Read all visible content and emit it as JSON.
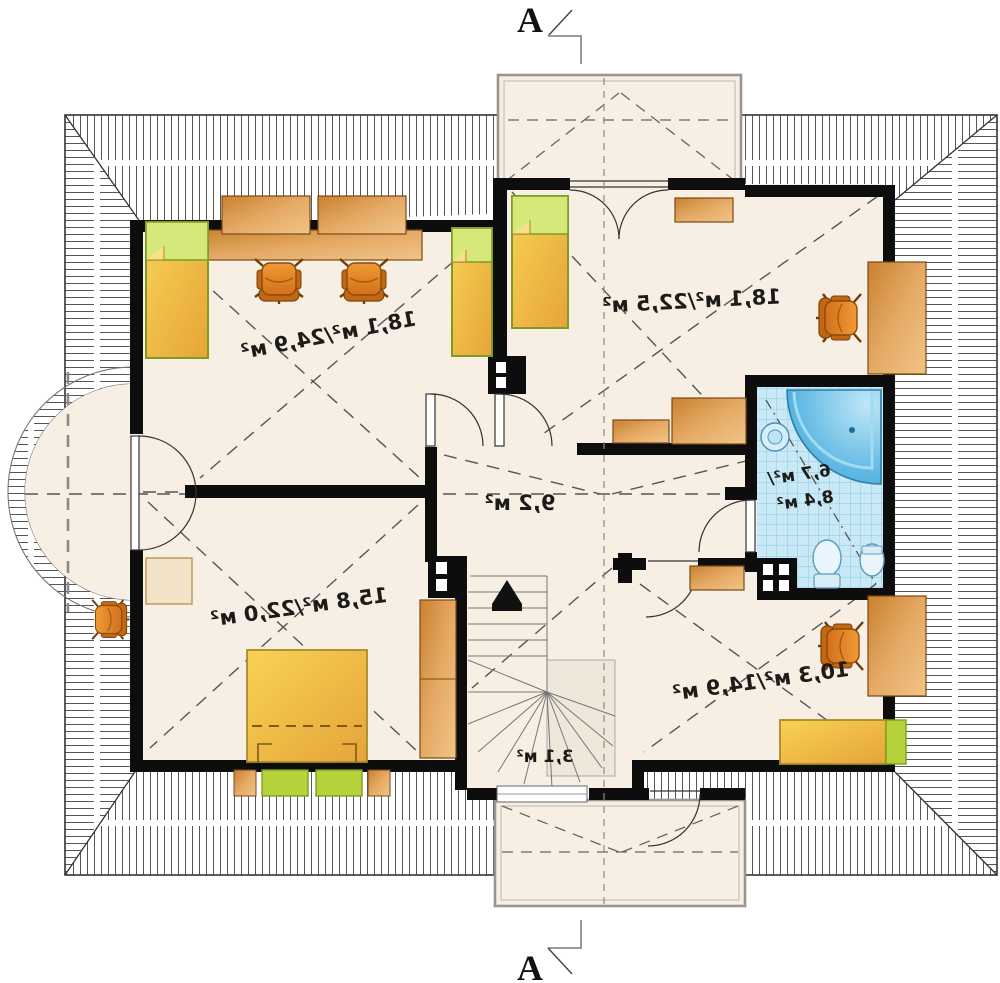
{
  "plan": {
    "kind": "attic-floor-plan",
    "section_marks": {
      "top": "A",
      "bottom": "A"
    },
    "rooms": [
      {
        "id": "room-topleft",
        "area_label": "18,1 м²/24,9 м²"
      },
      {
        "id": "room-topright",
        "area_label": "18,1 м²/22,5 м²"
      },
      {
        "id": "hall",
        "area_label": "9,2 м²"
      },
      {
        "id": "bathroom",
        "area_label_line1": "6,7 м²/",
        "area_label_line2": "8,4 м²"
      },
      {
        "id": "room-bottomleft",
        "area_label": "15,8 м²/22,0 м²"
      },
      {
        "id": "room-bottomright",
        "area_label": "10,3 м²/14,9 м²"
      },
      {
        "id": "stair-landing",
        "area_label": "3,1 м²"
      }
    ],
    "colors": {
      "floor": "#f7efe3",
      "wall": "#0d0d0d",
      "wood": "#d9944a",
      "chair": "#e8821e",
      "bed_yellow": "#f2bf3f",
      "bed_green": "#b5d23a",
      "bath_tile": "#c9e9f6",
      "tub_blue": "#57b7e4",
      "hatch_line": "#555555"
    }
  }
}
